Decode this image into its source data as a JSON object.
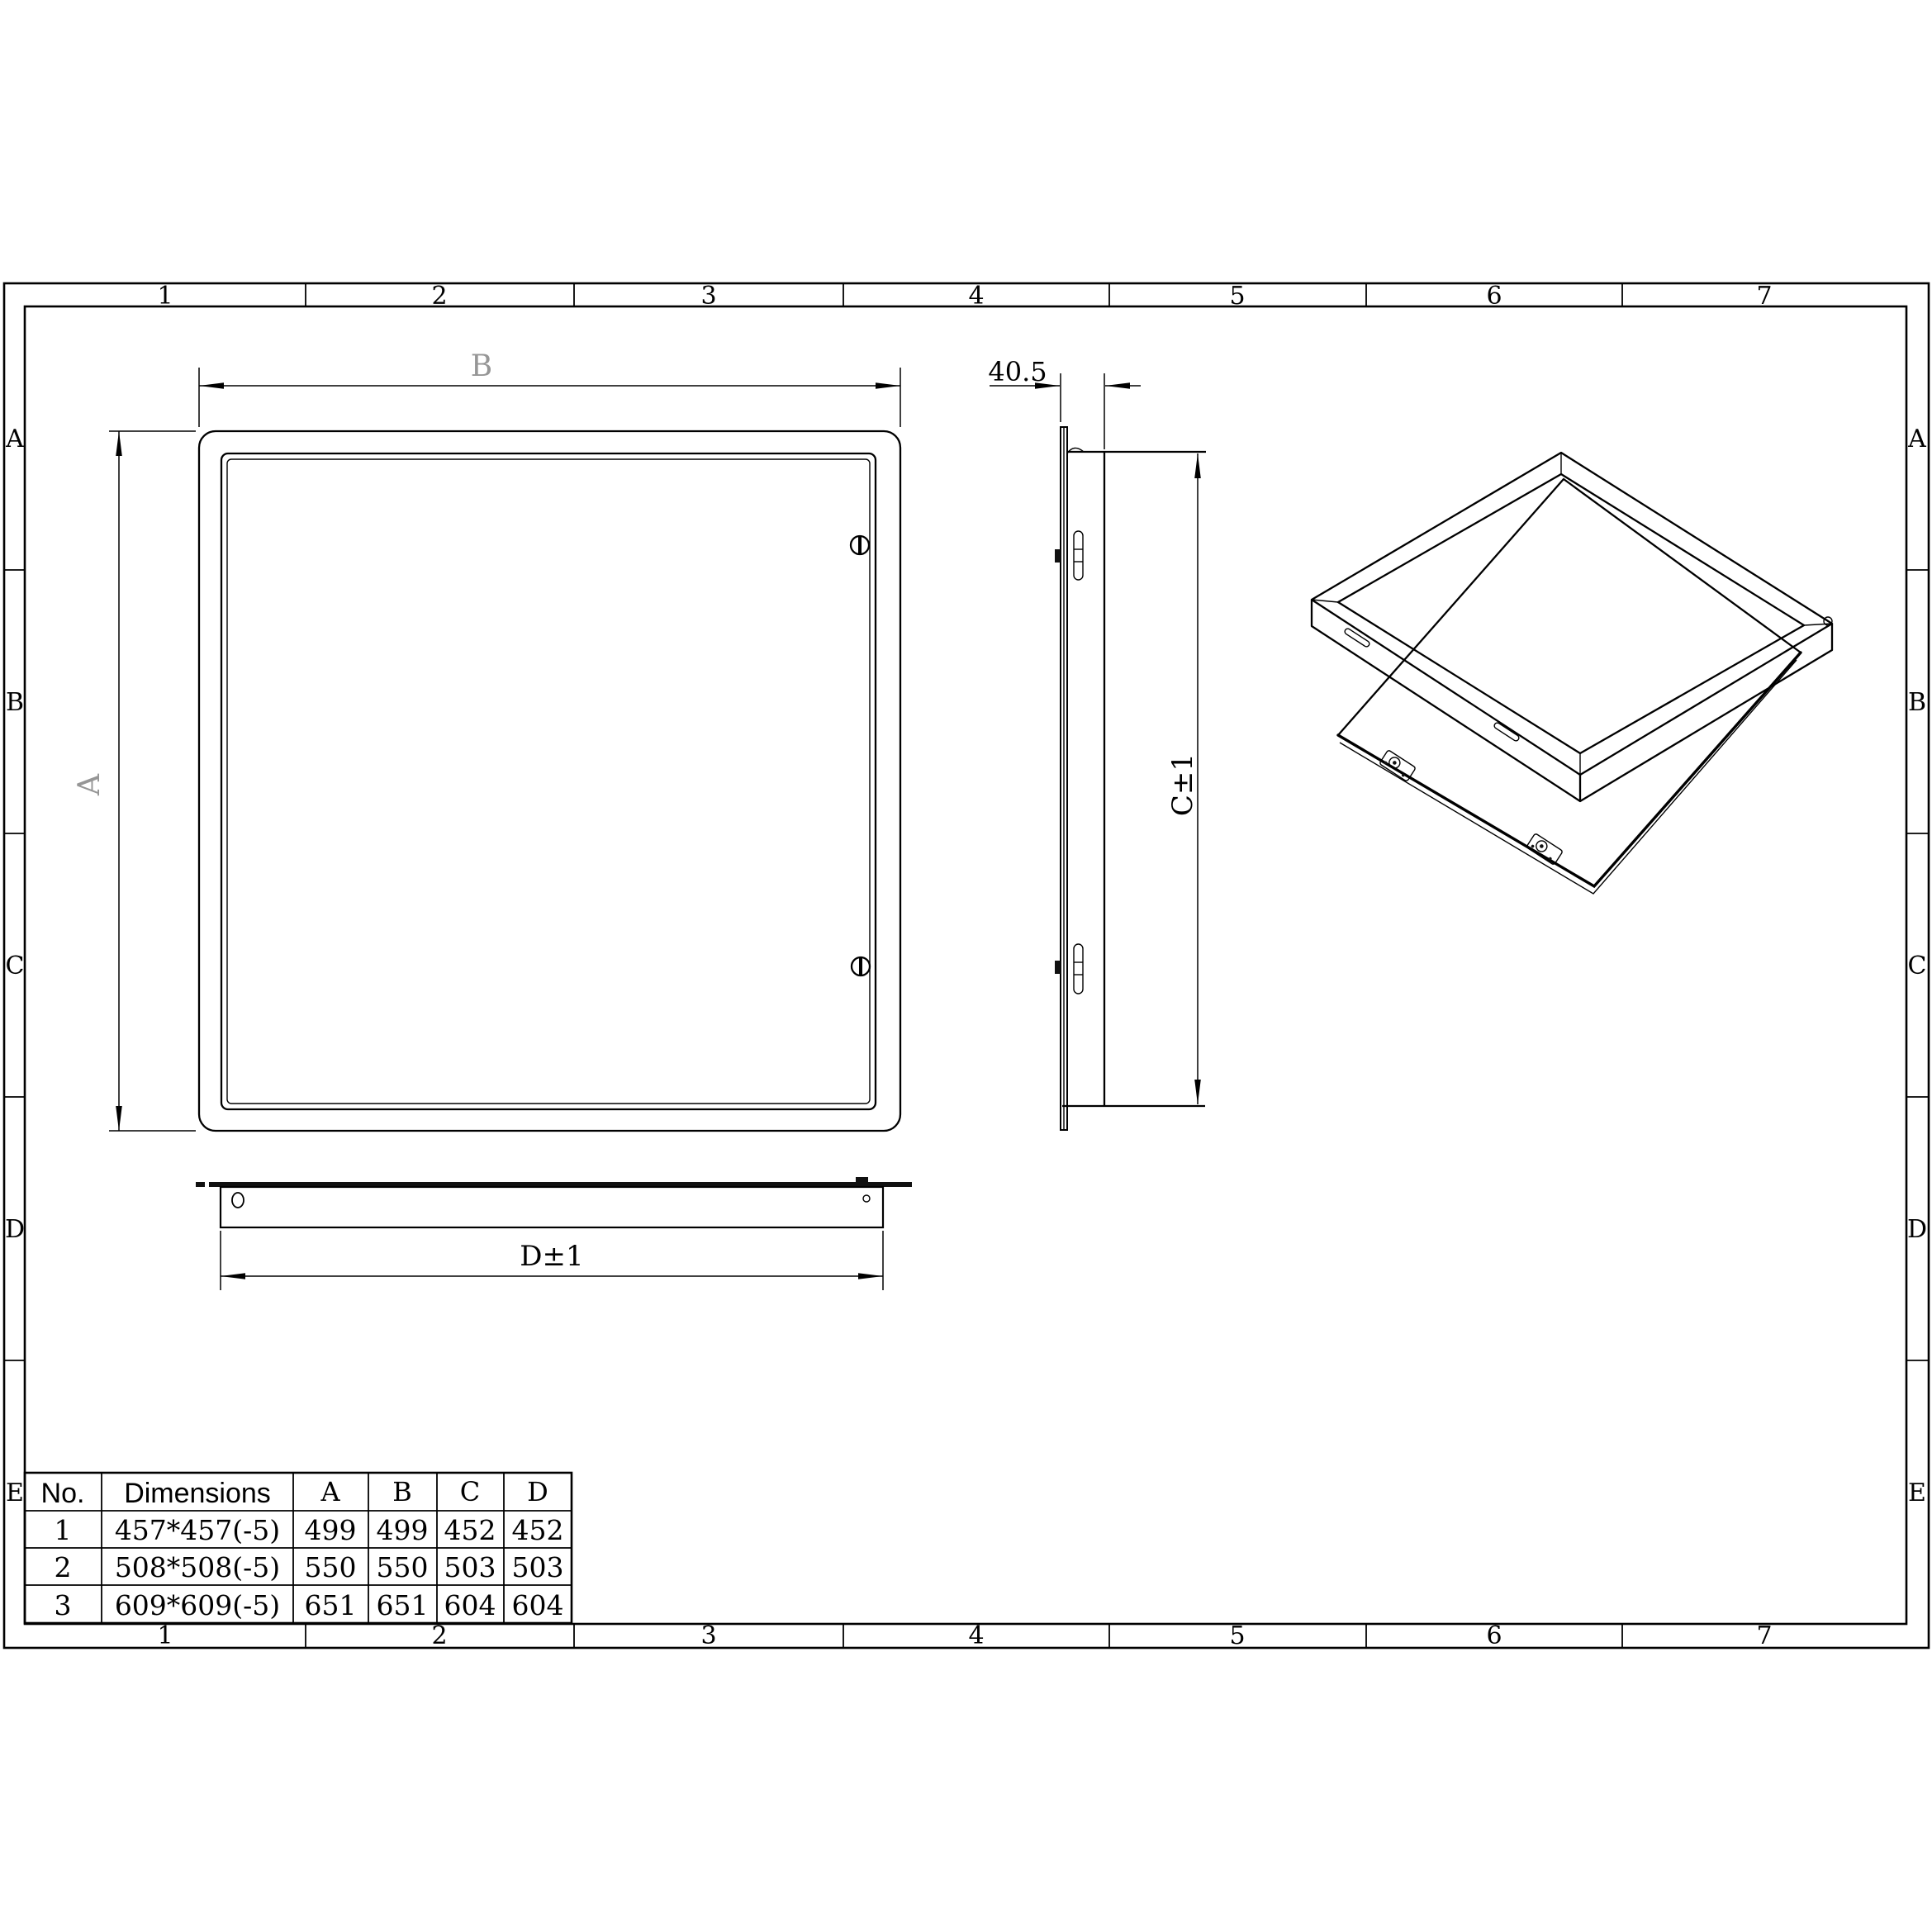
{
  "colors": {
    "line": "#000000",
    "background": "#ffffff",
    "reference_label": "#969696",
    "flange_fill": "#111111"
  },
  "grid": {
    "columns": [
      "1",
      "2",
      "3",
      "4",
      "5",
      "6",
      "7"
    ],
    "rows": [
      "A",
      "B",
      "C",
      "D",
      "E"
    ]
  },
  "front_view": {
    "width_label": "B",
    "height_label": "A"
  },
  "side_view": {
    "depth_label": "40.5",
    "height_label": "C±1"
  },
  "bottom_view": {
    "width_label": "D±1"
  },
  "table": {
    "headers": [
      "No.",
      "Dimensions",
      "A",
      "B",
      "C",
      "D"
    ],
    "rows": [
      [
        "1",
        "457*457(-5)",
        "499",
        "499",
        "452",
        "452"
      ],
      [
        "2",
        "508*508(-5)",
        "550",
        "550",
        "503",
        "503"
      ],
      [
        "3",
        "609*609(-5)",
        "651",
        "651",
        "604",
        "604"
      ]
    ]
  }
}
